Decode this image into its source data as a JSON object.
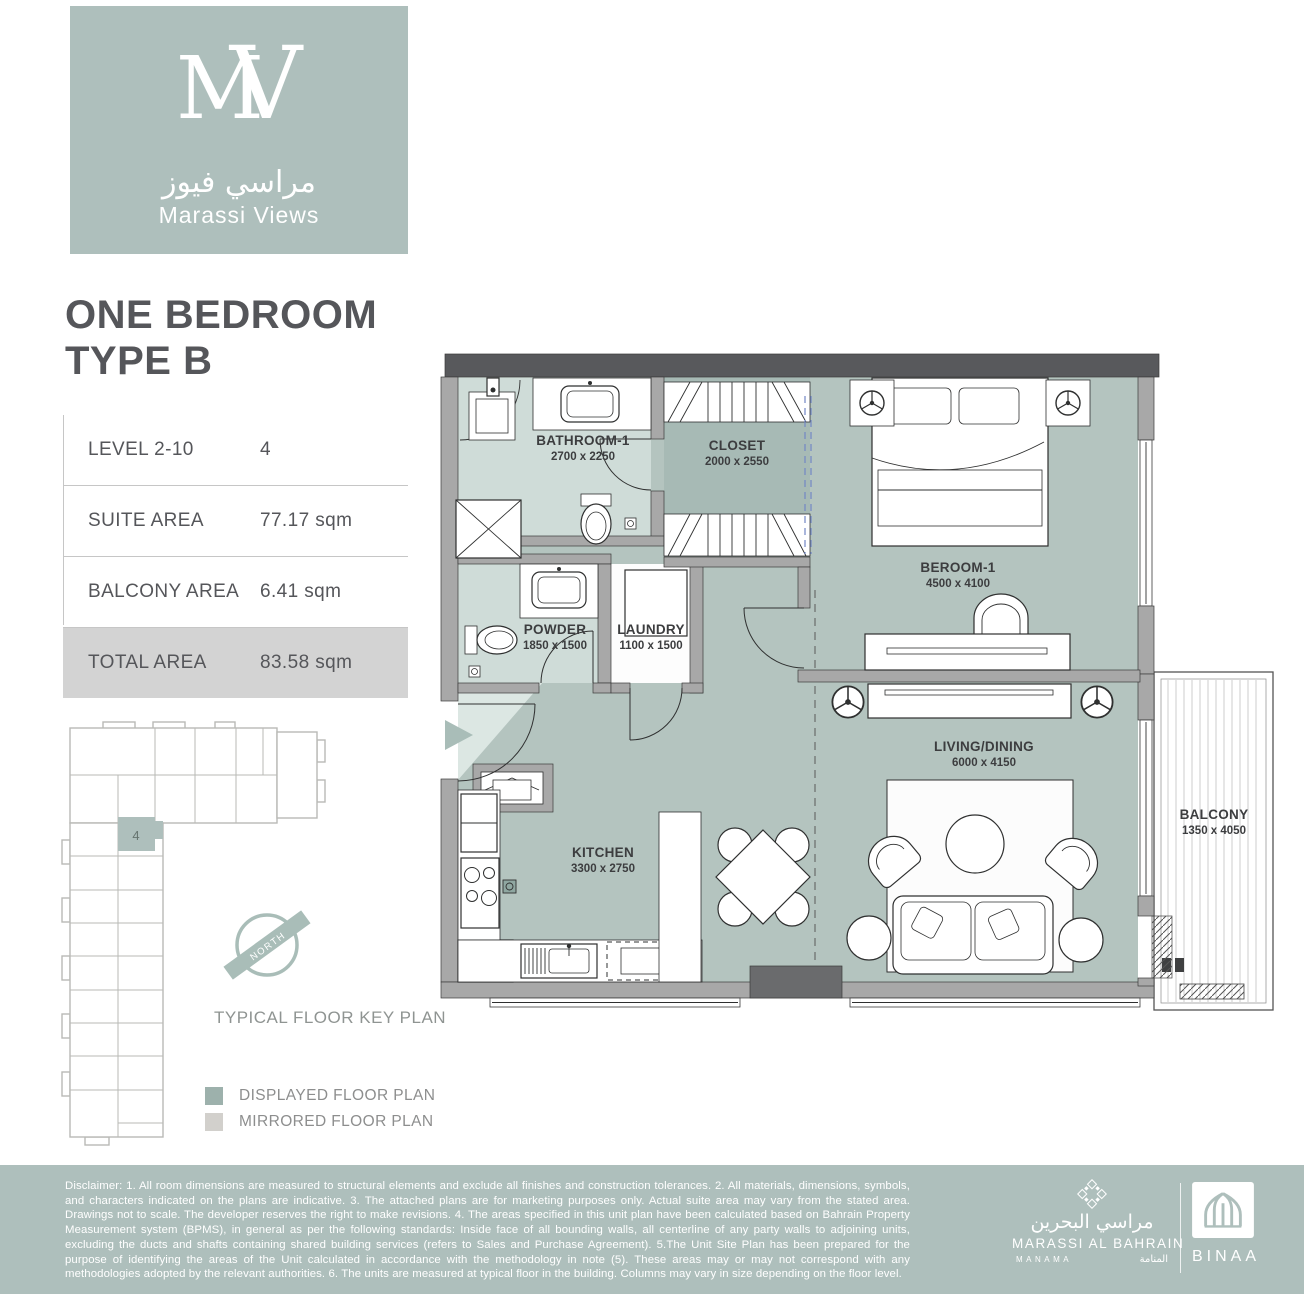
{
  "brand": {
    "monogram_left": "M",
    "monogram_right": "V",
    "name_arabic": "مراسي فيوز",
    "name_english": "Marassi Views"
  },
  "unit": {
    "title_line1": "ONE BEDROOM",
    "title_line2": "TYPE B",
    "specs": [
      {
        "label": "LEVEL 2-10",
        "value": "4"
      },
      {
        "label": "SUITE AREA",
        "value": "77.17 sqm"
      },
      {
        "label": "BALCONY AREA",
        "value": "6.41 sqm"
      },
      {
        "label": "TOTAL AREA",
        "value": "83.58 sqm"
      }
    ]
  },
  "floor_plan": {
    "rooms": [
      {
        "name": "BATHROOM-1",
        "dimensions": "2700 x 2250"
      },
      {
        "name": "CLOSET",
        "dimensions": "2000 x  2550"
      },
      {
        "name": "BEROOM-1",
        "dimensions": "4500 x 4100"
      },
      {
        "name": "POWDER",
        "dimensions": "1850 x 1500"
      },
      {
        "name": "LAUNDRY",
        "dimensions": "1100 x 1500"
      },
      {
        "name": "KITCHEN",
        "dimensions": "3300 x 2750"
      },
      {
        "name": "LIVING/DINING",
        "dimensions": "6000 x 4150"
      },
      {
        "name": "BALCONY",
        "dimensions": "1350 x 4050"
      }
    ]
  },
  "key_plan": {
    "unit_number": "4",
    "north_label": "NORTH",
    "caption": "TYPICAL FLOOR  KEY PLAN",
    "legend": [
      {
        "label": "DISPLAYED FLOOR PLAN"
      },
      {
        "label": "MIRRORED FLOOR PLAN"
      }
    ]
  },
  "footer": {
    "disclaimer": "Disclaimer: 1. All room dimensions are measured to structural elements and exclude all finishes and construction tolerances. 2. All materials, dimensions, symbols, and characters indicated on the plans are indicative. 3. The attached plans are for marketing purposes only. Actual suite area may vary from the stated area. Drawings not to scale. The developer reserves the right to make revisions. 4. The areas specified in this unit plan have been calculated based on Bahrain Property Measurement system (BPMS), in general as per the following standards: Inside face of all bounding walls, all centerline of any party walls to adjoining units, excluding the ducts and shafts containing shared building services (refers to Sales and Purchase Agreement). 5.The Unit Site Plan has been prepared for the purpose of identifying the areas of the Unit calculated in accordance with the methodology in note (5). These areas may or may not correspond with any methodologies adopted by the relevant authorities. 6. The units are measured at typical floor in the building. Columns may vary in size depending on the floor level.",
    "marassi": {
      "arabic": "مراسي البحرين",
      "english": "MARASSI AL BAHRAIN",
      "city": "MANAMA",
      "city_arabic": "المنامة"
    },
    "binaa": {
      "name": "BINAA"
    }
  },
  "colors": {
    "brand": "#aebfbc",
    "room": "#b4c4bf",
    "room_light": "#cfdcd8",
    "closet": "#a7bab5",
    "wall": "#a8a8a8",
    "wall_dark": "#58595c",
    "highlight_row": "#d3d3d3",
    "legend_displayed": "#9db1ac",
    "legend_mirrored": "#d2d0cc"
  }
}
